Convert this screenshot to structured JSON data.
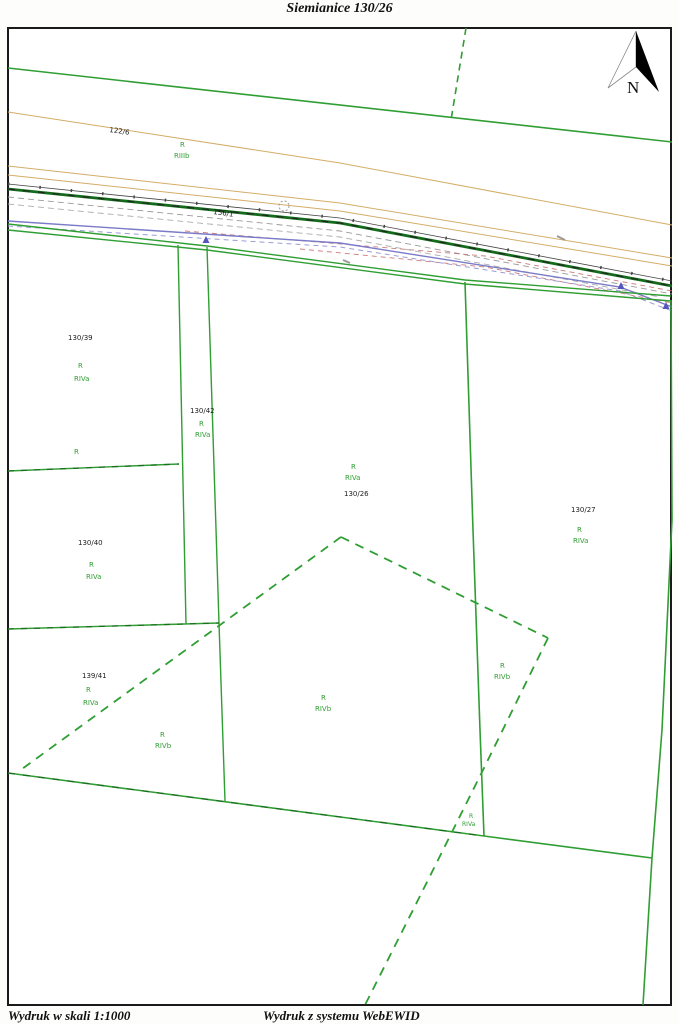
{
  "title": "Siemianice 130/26",
  "footer": {
    "scale_note": "Wydruk w skali 1:1000",
    "system_note": "Wydruk z systemu WebEWID"
  },
  "north_arrow_label": "N",
  "colors": {
    "green": "#2f9e33",
    "dark_green": "#1c6b22",
    "black": "#1c1c1c",
    "tan": "#d4ad68",
    "gray": "#9a9a9a",
    "red": "#cc7a7a",
    "blue": "#7b7bc8",
    "light_blue": "#9c9cd8",
    "frame": "#1a1a1a"
  },
  "map": {
    "labels": [
      {
        "text": "122/6",
        "x": 110,
        "y": 126,
        "color": "black",
        "rotate": 8
      },
      {
        "text": "R",
        "x": 180,
        "y": 141,
        "color": "green"
      },
      {
        "text": "RIIIb",
        "x": 174,
        "y": 152,
        "color": "green"
      },
      {
        "text": "156/1",
        "x": 214,
        "y": 208,
        "color": "black",
        "rotate": 8
      },
      {
        "text": "130/39",
        "x": 68,
        "y": 334,
        "color": "black"
      },
      {
        "text": "R",
        "x": 78,
        "y": 362,
        "color": "green"
      },
      {
        "text": "RIVa",
        "x": 74,
        "y": 375,
        "color": "green"
      },
      {
        "text": "130/42",
        "x": 190,
        "y": 407,
        "color": "black"
      },
      {
        "text": "R",
        "x": 199,
        "y": 420,
        "color": "green"
      },
      {
        "text": "RIVa",
        "x": 195,
        "y": 431,
        "color": "green"
      },
      {
        "text": "R",
        "x": 74,
        "y": 448,
        "color": "green"
      },
      {
        "text": "130/40",
        "x": 78,
        "y": 539,
        "color": "black"
      },
      {
        "text": "R",
        "x": 89,
        "y": 561,
        "color": "green"
      },
      {
        "text": "RIVa",
        "x": 86,
        "y": 573,
        "color": "green"
      },
      {
        "text": "R",
        "x": 351,
        "y": 463,
        "color": "green"
      },
      {
        "text": "RIVa",
        "x": 345,
        "y": 474,
        "color": "green"
      },
      {
        "text": "130/26",
        "x": 344,
        "y": 490,
        "color": "black"
      },
      {
        "text": "130/27",
        "x": 571,
        "y": 506,
        "color": "black"
      },
      {
        "text": "R",
        "x": 577,
        "y": 526,
        "color": "green"
      },
      {
        "text": "RIVa",
        "x": 573,
        "y": 537,
        "color": "green"
      },
      {
        "text": "139/41",
        "x": 82,
        "y": 672,
        "color": "black"
      },
      {
        "text": "R",
        "x": 86,
        "y": 686,
        "color": "green"
      },
      {
        "text": "RIVa",
        "x": 83,
        "y": 699,
        "color": "green"
      },
      {
        "text": "R",
        "x": 160,
        "y": 731,
        "color": "green"
      },
      {
        "text": "RIVb",
        "x": 155,
        "y": 742,
        "color": "green"
      },
      {
        "text": "R",
        "x": 321,
        "y": 694,
        "color": "green"
      },
      {
        "text": "RIVb",
        "x": 315,
        "y": 705,
        "color": "green"
      },
      {
        "text": "R",
        "x": 500,
        "y": 662,
        "color": "green"
      },
      {
        "text": "RIVb",
        "x": 494,
        "y": 673,
        "color": "green"
      },
      {
        "text": "R",
        "x": 469,
        "y": 813,
        "color": "green",
        "size": 6
      },
      {
        "text": "RIVa",
        "x": 462,
        "y": 821,
        "color": "green",
        "size": 6
      }
    ],
    "lines": [
      {
        "name": "boundary-north",
        "points": [
          [
            8,
            68
          ],
          [
            672,
            142
          ]
        ],
        "color": "#2f9e33",
        "w": 1.6
      },
      {
        "name": "boundary-north-dashed",
        "points": [
          [
            466,
            28
          ],
          [
            451,
            120
          ]
        ],
        "color": "#2f9e33",
        "w": 1.6,
        "dash": "7 5"
      },
      {
        "name": "road-edge-tan-1",
        "points": [
          [
            8,
            112
          ],
          [
            340,
            163
          ],
          [
            672,
            225
          ]
        ],
        "color": "#d4ad68",
        "w": 1
      },
      {
        "name": "road-edge-tan-2",
        "points": [
          [
            8,
            166
          ],
          [
            340,
            203
          ],
          [
            672,
            258
          ]
        ],
        "color": "#d4ad68",
        "w": 1
      },
      {
        "name": "road-edge-tan-3",
        "points": [
          [
            8,
            175
          ],
          [
            340,
            211
          ],
          [
            672,
            266
          ]
        ],
        "color": "#d4ad68",
        "w": 1
      },
      {
        "name": "road-line-black",
        "points": [
          [
            8,
            184
          ],
          [
            340,
            218
          ],
          [
            672,
            281
          ]
        ],
        "color": "#444444",
        "w": 0.8
      },
      {
        "name": "road-line-black-ticks",
        "points": [
          [
            8,
            184
          ],
          [
            340,
            218
          ],
          [
            672,
            281
          ]
        ],
        "color": "#444444",
        "w": 3,
        "dash": "1.5 30"
      },
      {
        "name": "road-line-green-thick",
        "points": [
          [
            8,
            189
          ],
          [
            340,
            223
          ],
          [
            672,
            286
          ]
        ],
        "color": "#156b1c",
        "w": 2.8
      },
      {
        "name": "road-line-green-thick-dashes",
        "points": [
          [
            8,
            189
          ],
          [
            340,
            223
          ],
          [
            672,
            286
          ]
        ],
        "color": "#222222",
        "w": 1.1,
        "dash": "7 8"
      },
      {
        "name": "road-line-gray-dashed-1",
        "points": [
          [
            8,
            197
          ],
          [
            340,
            231
          ],
          [
            672,
            294
          ]
        ],
        "color": "#9a9a9a",
        "w": 0.9,
        "dash": "6 4"
      },
      {
        "name": "road-line-gray-dashed-2",
        "points": [
          [
            8,
            204
          ],
          [
            340,
            237
          ],
          [
            660,
            297
          ]
        ],
        "color": "#ababab",
        "w": 0.9,
        "dash": "6 4"
      },
      {
        "name": "road-line-red-dashed-1",
        "points": [
          [
            185,
            231
          ],
          [
            485,
            256
          ],
          [
            672,
            291
          ]
        ],
        "color": "#cc7a7a",
        "w": 0.9,
        "dash": "5 4"
      },
      {
        "name": "road-line-red-dashed-2",
        "points": [
          [
            300,
            249
          ],
          [
            485,
            267
          ],
          [
            672,
            303
          ]
        ],
        "color": "#cc7a7a",
        "w": 0.9,
        "dash": "5 4"
      },
      {
        "name": "utility-line-blue",
        "points": [
          [
            8,
            221
          ],
          [
            340,
            243
          ],
          [
            620,
            287
          ],
          [
            672,
            307
          ]
        ],
        "color": "#7b7bc8",
        "w": 1.4
      },
      {
        "name": "utility-line-blue-dashed",
        "points": [
          [
            8,
            226
          ],
          [
            340,
            247
          ],
          [
            620,
            291
          ],
          [
            672,
            311
          ]
        ],
        "color": "#9c9cd8",
        "w": 1,
        "dash": "5 4"
      },
      {
        "name": "tiny-annotation-mark-1",
        "points": [
          [
            557,
            236
          ],
          [
            565,
            240
          ]
        ],
        "color": "#999999",
        "w": 2
      },
      {
        "name": "tiny-annotation-mark-2",
        "points": [
          [
            343,
            260
          ],
          [
            350,
            263
          ]
        ],
        "color": "#999999",
        "w": 2
      },
      {
        "name": "road-south-edge-1",
        "points": [
          [
            8,
            224
          ],
          [
            207,
            246
          ],
          [
            465,
            280
          ],
          [
            671,
            296
          ]
        ],
        "color": "#2f9e33",
        "w": 1.4
      },
      {
        "name": "road-south-edge-2",
        "points": [
          [
            8,
            230
          ],
          [
            207,
            250
          ],
          [
            465,
            284
          ],
          [
            671,
            301
          ]
        ],
        "color": "#2f9e33",
        "w": 1.4
      },
      {
        "name": "strip-west-line",
        "points": [
          [
            178,
            245
          ],
          [
            186,
            624
          ]
        ],
        "color": "#2f9e33",
        "w": 1.4
      },
      {
        "name": "strip-east-line",
        "points": [
          [
            207,
            247
          ],
          [
            219,
            623
          ],
          [
            225,
            801
          ]
        ],
        "color": "#2f9e33",
        "w": 1.4
      },
      {
        "name": "parcel-line-h1",
        "points": [
          [
            8,
            471
          ],
          [
            179,
            464
          ]
        ],
        "color": "#2f9e33",
        "w": 1.4
      },
      {
        "name": "parcel-line-h1-dashes",
        "points": [
          [
            8,
            471
          ],
          [
            179,
            464
          ]
        ],
        "color": "#1c6b22",
        "w": 1.2,
        "dash": "6 7"
      },
      {
        "name": "parcel-line-h2",
        "points": [
          [
            8,
            629
          ],
          [
            219,
            623
          ]
        ],
        "color": "#2f9e33",
        "w": 1.4
      },
      {
        "name": "parcel-line-h2-dashes",
        "points": [
          [
            8,
            629
          ],
          [
            219,
            623
          ]
        ],
        "color": "#1c6b22",
        "w": 1.2,
        "dash": "6 7"
      },
      {
        "name": "use-boundary-dashed-west",
        "points": [
          [
            341,
            537
          ],
          [
            22,
            769
          ]
        ],
        "color": "#2f9e33",
        "w": 1.8,
        "dash": "9 7"
      },
      {
        "name": "use-boundary-dashed-east",
        "points": [
          [
            341,
            537
          ],
          [
            548,
            638
          ]
        ],
        "color": "#2f9e33",
        "w": 1.8,
        "dash": "9 7"
      },
      {
        "name": "use-boundary-dashed-south",
        "points": [
          [
            548,
            638
          ],
          [
            483,
            770
          ],
          [
            413,
            910
          ],
          [
            365,
            1005
          ]
        ],
        "color": "#2f9e33",
        "w": 1.8,
        "dash": "9 7"
      },
      {
        "name": "boundary-southwest",
        "points": [
          [
            8,
            773
          ],
          [
            484,
            836
          ]
        ],
        "color": "#2f9e33",
        "w": 1.6
      },
      {
        "name": "boundary-southwest-dashes",
        "points": [
          [
            8,
            773
          ],
          [
            484,
            836
          ]
        ],
        "color": "#1c6b22",
        "w": 1.2,
        "dash": "7 8"
      },
      {
        "name": "boundary-south",
        "points": [
          [
            484,
            836
          ],
          [
            652,
            858
          ]
        ],
        "color": "#2f9e33",
        "w": 1.6
      },
      {
        "name": "parcel-boundary-26-27",
        "points": [
          [
            465,
            282
          ],
          [
            473,
            530
          ],
          [
            480,
            730
          ],
          [
            484,
            836
          ]
        ],
        "color": "#2f9e33",
        "w": 1.6
      },
      {
        "name": "boundary-east",
        "points": [
          [
            671,
            300
          ],
          [
            672,
            520
          ],
          [
            662,
            730
          ],
          [
            652,
            858
          ],
          [
            643,
            1005
          ]
        ],
        "color": "#2f9e33",
        "w": 1.6
      }
    ],
    "markers": [
      {
        "name": "arrow-marker-blue-1",
        "x": 206,
        "y": 240,
        "color": "#5555bb"
      },
      {
        "name": "arrow-marker-blue-2",
        "x": 621,
        "y": 286,
        "color": "#5555bb"
      },
      {
        "name": "arrow-marker-blue-3",
        "x": 666,
        "y": 306,
        "color": "#5555bb"
      }
    ],
    "symbols": [
      {
        "name": "circle-symbol",
        "x": 284,
        "y": 206,
        "r": 5,
        "color": "#999999"
      }
    ]
  }
}
